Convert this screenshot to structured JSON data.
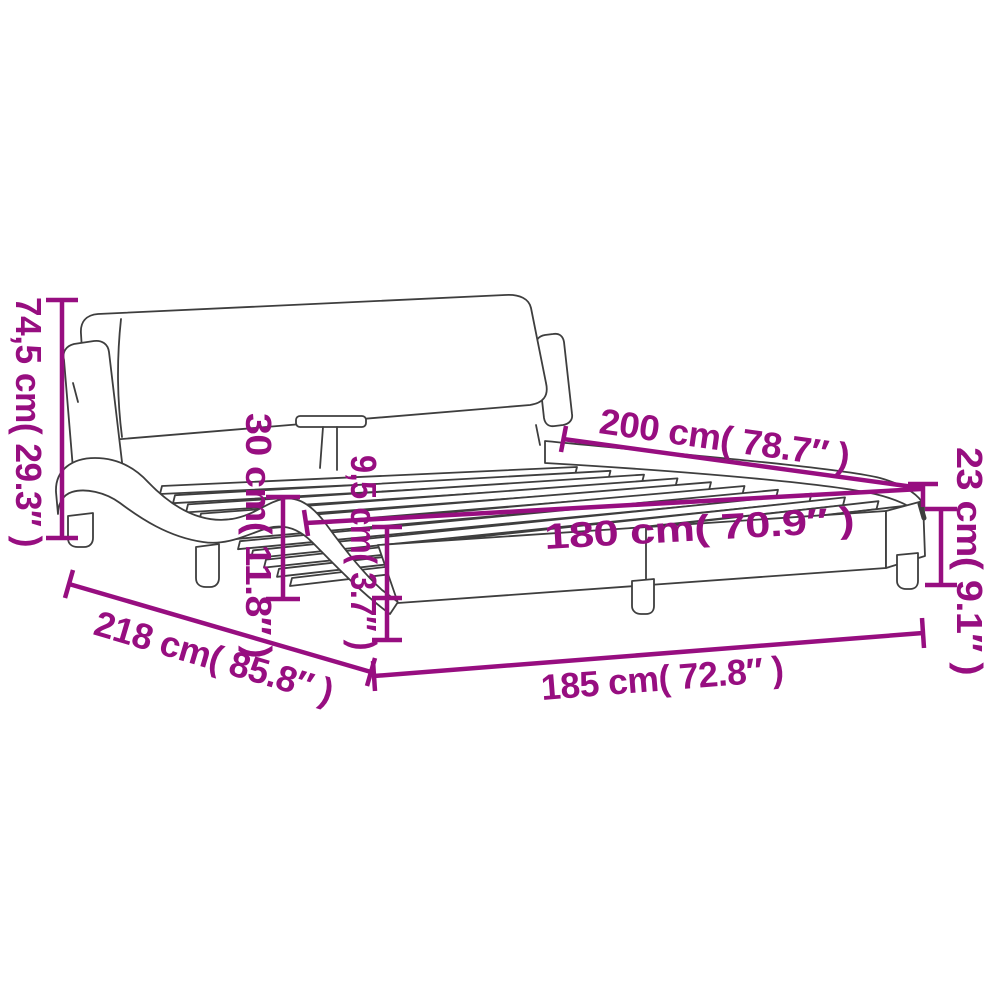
{
  "figure": {
    "name": "bed-frame-dimensions-diagram",
    "subject": "bed frame with headboard",
    "accent_color": "#970e80",
    "line_color": "#3e3e3e",
    "background_color": "#ffffff"
  },
  "dimensions": {
    "total_height": "74,5 cm( 29.3″ )",
    "headboard_to_slats": "30 cm( 11.8″ )",
    "rail_thickness": "9,5 cm( 3.7″ )",
    "inner_length": "200 cm( 78.7″ )",
    "inner_width": "180 cm( 70.9″ )",
    "frame_height": "23 cm( 9.1″ )",
    "total_length": "218 cm( 85.8″ )",
    "total_width": "185 cm( 72.8″ )"
  }
}
